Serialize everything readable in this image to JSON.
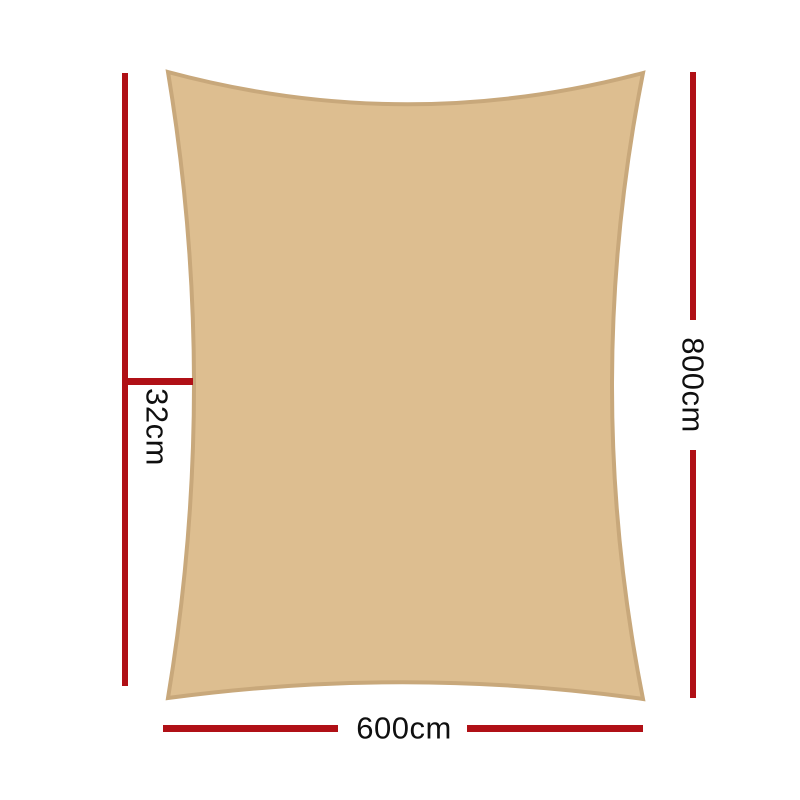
{
  "diagram": {
    "labels": {
      "height": "800cm",
      "width": "600cm",
      "offset": "32cm"
    },
    "colors": {
      "page_background": "#ffffff",
      "sail_fill": "#ddbe90",
      "sail_stroke": "#c8a87b",
      "dimension_line": "#b01016",
      "label_text": "#0f0f0f"
    }
  }
}
